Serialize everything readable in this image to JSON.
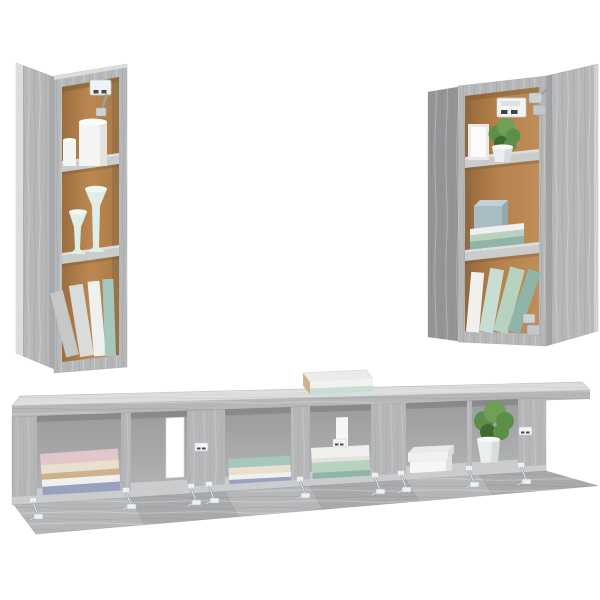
{
  "canvas": {
    "width": 600,
    "height": 600,
    "background": "#ffffff"
  },
  "colors": {
    "background": "#ffffff",
    "wood": "#b6b7b9",
    "woodLight": "#cbccce",
    "woodLighter": "#dcddde",
    "woodMid": "#a9aaac",
    "woodDark": "#939496",
    "woodDeep": "#7f8082",
    "kraft": "#b8854f",
    "kraftDark": "#96683c",
    "metal": "#c4c8cc",
    "metalDark": "#9aa0a6",
    "candle": "#f4f5f2",
    "mint": "#dfeee8",
    "mintTop": "#eef7f2",
    "plant": "#5c8f4a",
    "plantDark": "#40692f",
    "plantLight": "#6fa053",
    "pot": "#eceeee",
    "potShade": "#d3d7d8",
    "boxBlue": "#a9bcc4",
    "boxBlueLight": "#c2d1d7",
    "boxBlueDark": "#93a8b1",
    "bookPink": "#e2c6cb",
    "bookCream": "#e8e0cc",
    "bookTan": "#cdb28b",
    "bookWhite": "#f0f1ef",
    "bookPurple": "#9aa0bf",
    "bookTeal": "#a5c8be",
    "bookGreen": "#b7d2bf",
    "bookDarkTeal": "#8fb5a9",
    "bookMint": "#c8ded3",
    "bookGray": "#c6c8c7"
  },
  "scene": {
    "alt": "Product photo of a grey sonoma oak TV wall-cabinet set on a white background: two tall wall cabinets with open doors (holding candles, candle holders, a picture frame, a potted plant and books) above a long floating TV bench with six open compartments, fold-down doors open, holding stacked books, a white storage box and a green potted plant, with a stack of books on top",
    "left_cabinet": {
      "label": "tall wall cabinet with door open to the left",
      "shelf_items": [
        "white pillar candles with metal hinge",
        "two mint candle holders",
        "leaning books"
      ]
    },
    "right_cabinet": {
      "label": "tall wall cabinet with door open to the right",
      "shelf_items": [
        "wall bracket and hinge",
        "picture frame and potted plant",
        "storage box on stacked books",
        "leaning books with hinge"
      ]
    },
    "tv_bench": {
      "label": "wall-mounted TV bench with six open compartments and fold-down doors hanging open",
      "compartment_items": [
        "stack of pastel books",
        "empty with wall gap",
        "stack of books",
        "stack of books",
        "white storage box",
        "potted green plant"
      ],
      "top_item": "stack of books with mint cover"
    }
  }
}
